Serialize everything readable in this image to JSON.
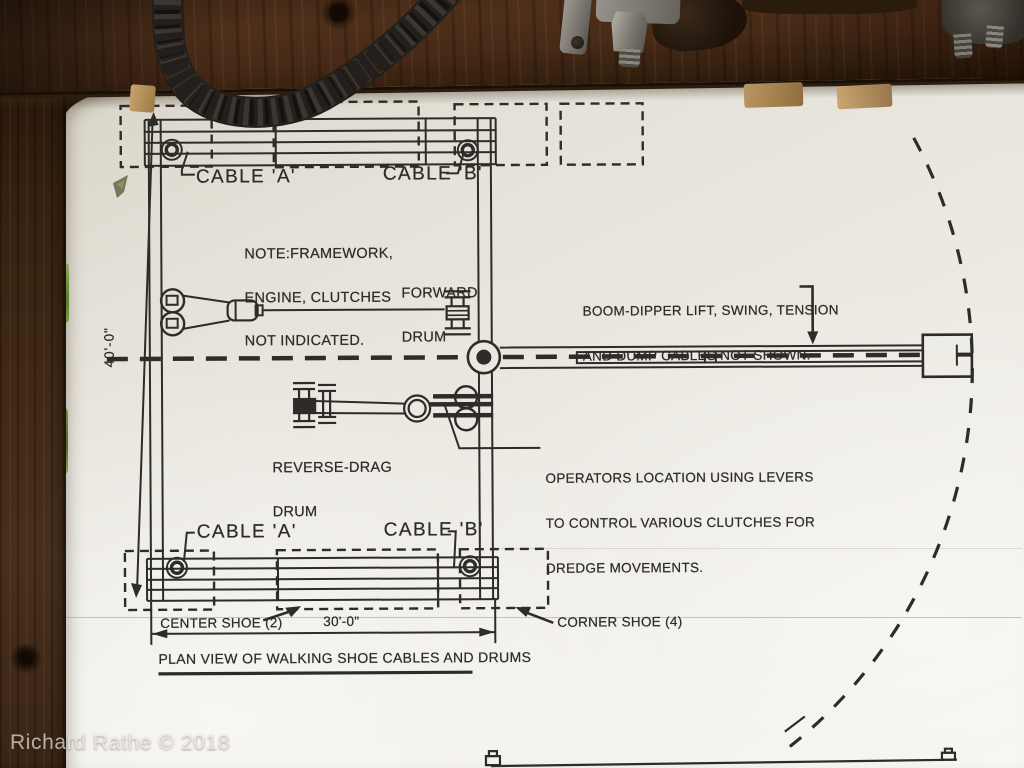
{
  "palette": {
    "board_bg": "#ebe8e1",
    "line_ink": "#2e2c27",
    "wood_beam": "#46291c",
    "wood_post": "#3d2718",
    "cable": "#221f1d",
    "foliage": "#7d9a45"
  },
  "diagram": {
    "title": "PLAN VIEW OF WALKING SHOE CABLES AND DRUMS",
    "cable_a_top": "CABLE 'A'",
    "cable_b_top": "CABLE 'B'",
    "cable_a_bottom": "CABLE 'A'",
    "cable_b_bottom": "CABLE 'B'",
    "note": [
      "NOTE:FRAMEWORK,",
      "ENGINE, CLUTCHES",
      "NOT INDICATED."
    ],
    "forward_drum": [
      "FORWARD",
      "DRUM"
    ],
    "reverse_drag_drum": [
      "REVERSE-DRAG",
      "DRUM"
    ],
    "boom_note": [
      "BOOM-DIPPER LIFT, SWING, TENSION",
      "AND DUMP CABLES NOT SHOWN."
    ],
    "operators_note": [
      "OPERATORS LOCATION USING LEVERS",
      "TO CONTROL VARIOUS CLUTCHES FOR",
      "DREDGE MOVEMENTS."
    ],
    "center_shoe": "CENTER SHOE (2)",
    "corner_shoe": "CORNER SHOE (4)",
    "dim_height": "40'-0\"",
    "dim_width": "30'-0\""
  },
  "photo": {
    "watermark": "Richard Rathe © 2018"
  }
}
